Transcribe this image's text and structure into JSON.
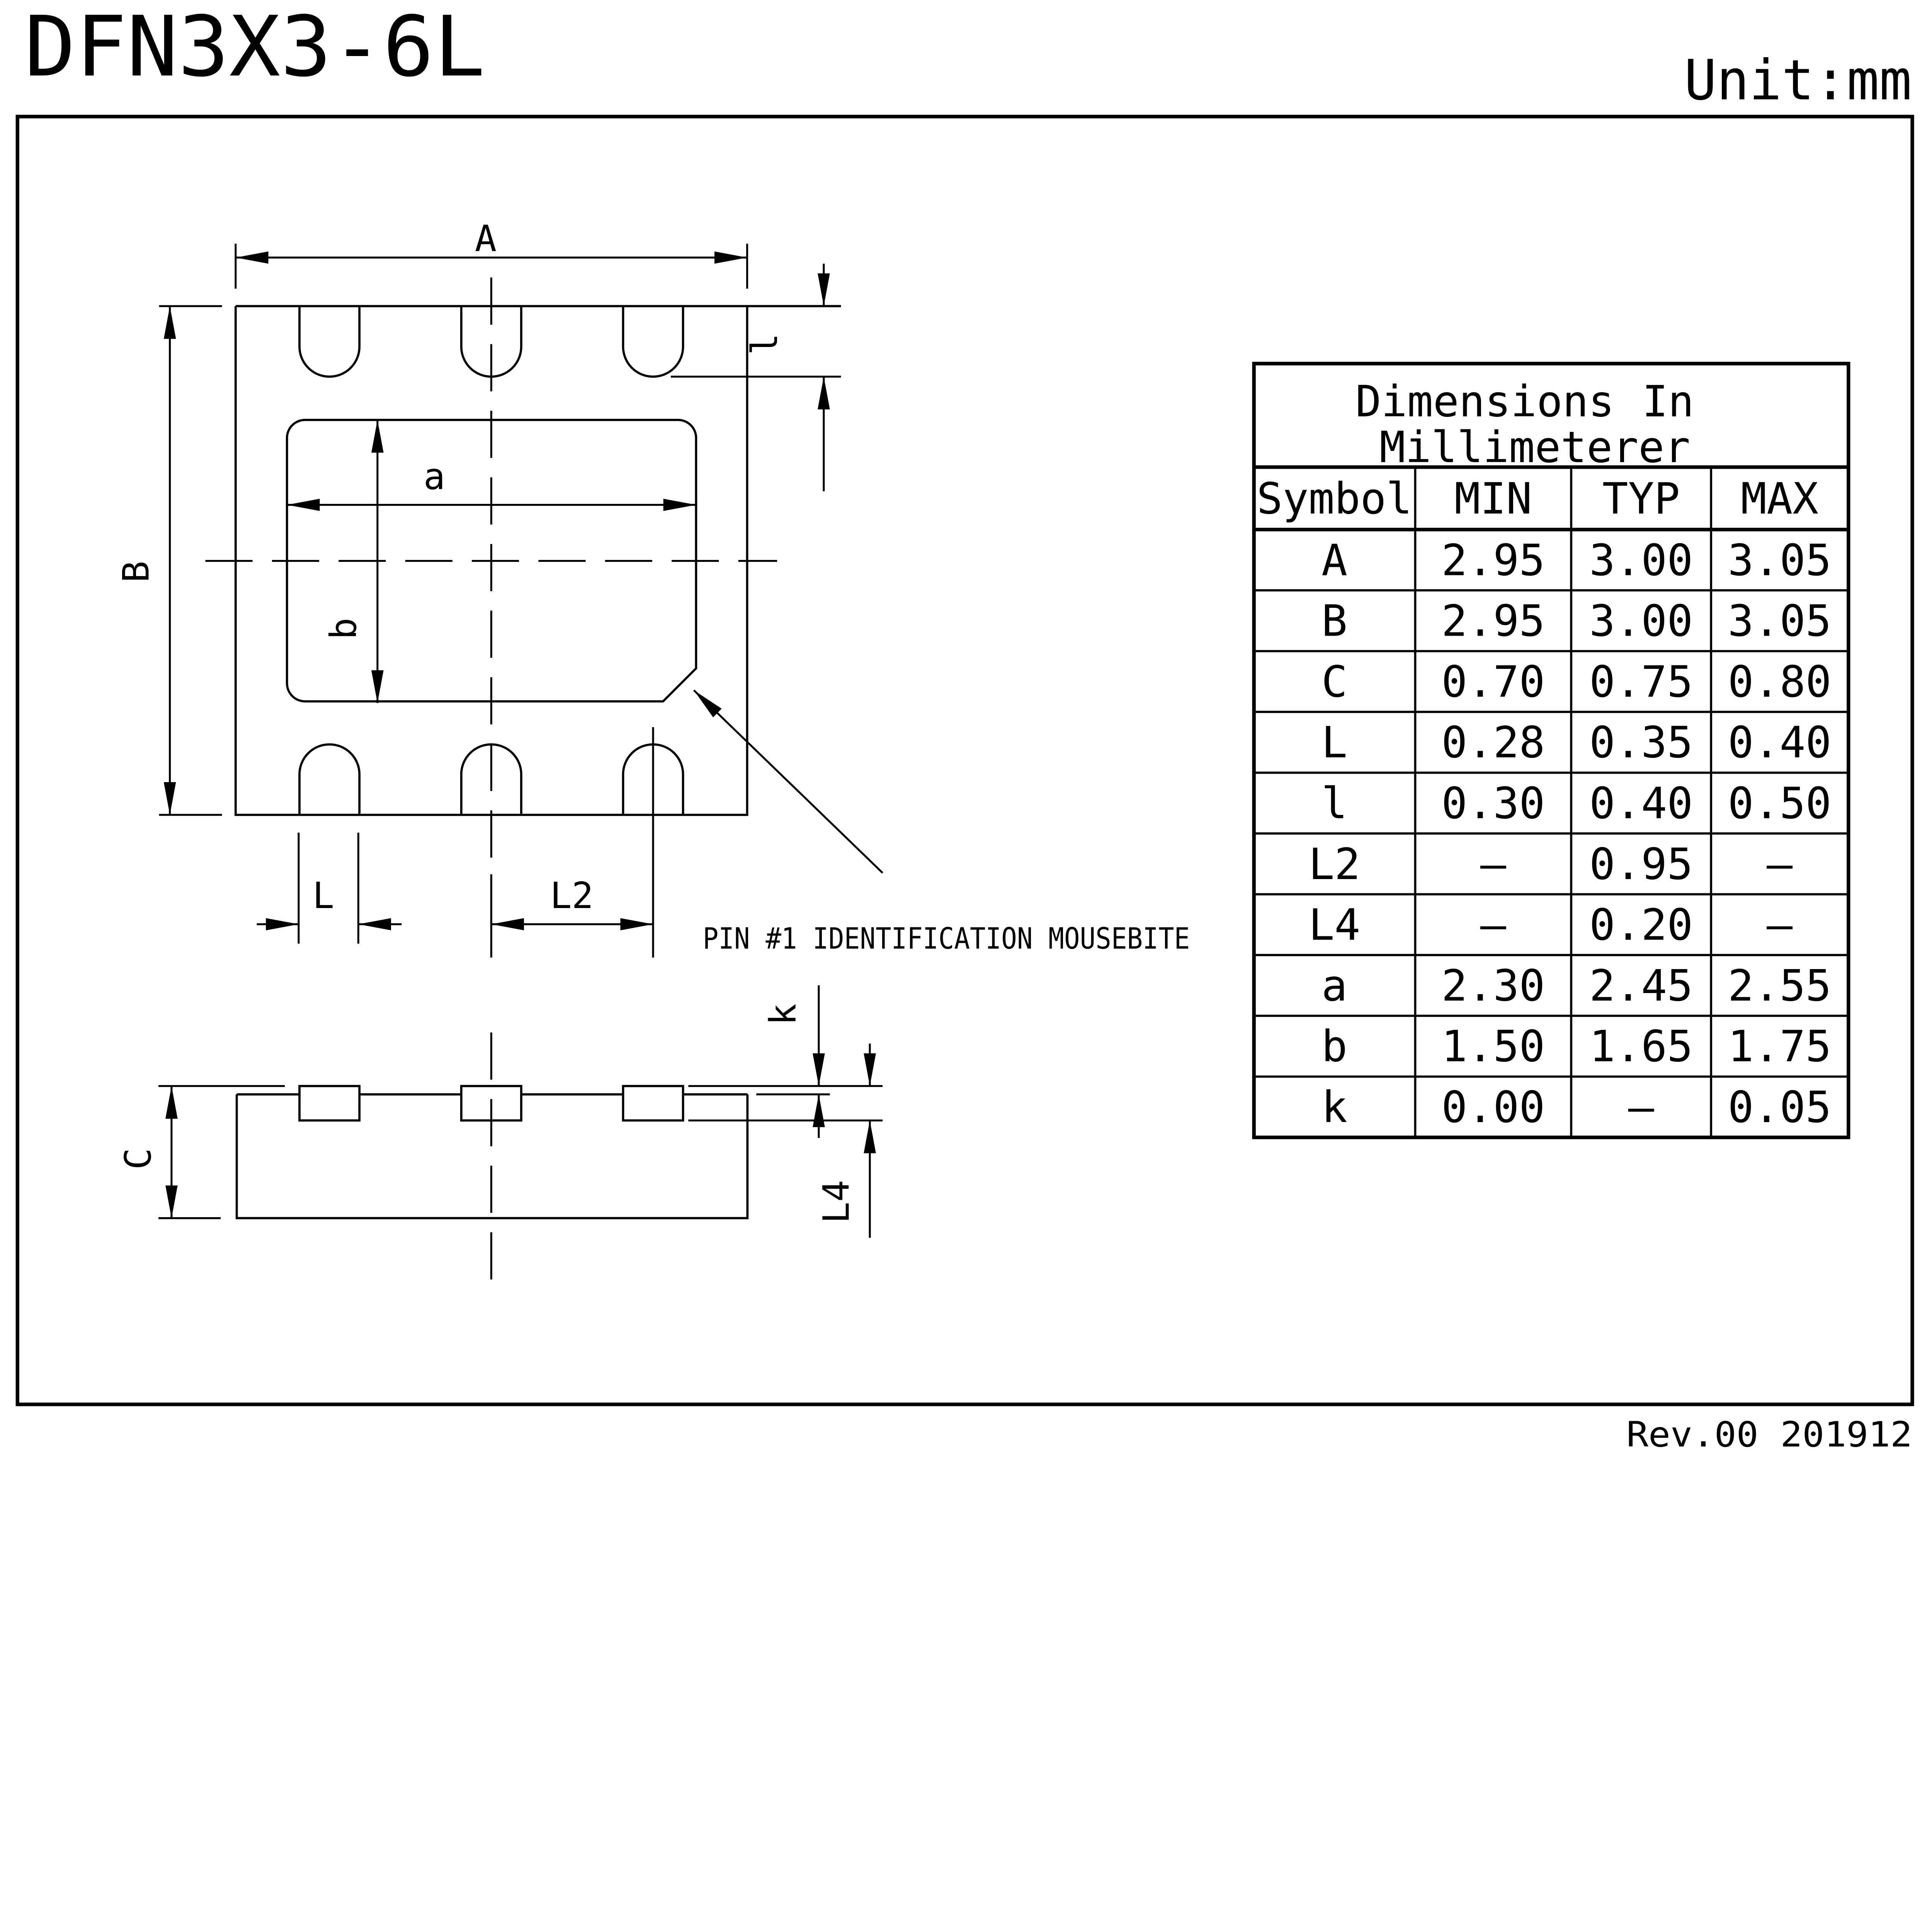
{
  "title": "DFN3X3-6L",
  "unit_label": "Unit:mm",
  "revision": "Rev.00  201912",
  "drawing": {
    "pin1_note": "PIN #1 IDENTIFICATION MOUSEBITE",
    "labels": {
      "A": "A",
      "B": "B",
      "a": "a",
      "b": "b",
      "small_l": "l",
      "L": "L",
      "L2": "L2",
      "C": "C",
      "k": "k",
      "L4": "L4"
    }
  },
  "table": {
    "title_word1": "Dimensions",
    "title_word2": "In",
    "title_line2": "Millimeterer",
    "headers": {
      "symbol": "Symbol",
      "min": "MIN",
      "typ": "TYP",
      "max": "MAX"
    },
    "rows": [
      {
        "symbol": "A",
        "min": "2.95",
        "typ": "3.00",
        "max": "3.05"
      },
      {
        "symbol": "B",
        "min": "2.95",
        "typ": "3.00",
        "max": "3.05"
      },
      {
        "symbol": "C",
        "min": "0.70",
        "typ": "0.75",
        "max": "0.80"
      },
      {
        "symbol": "L",
        "min": "0.28",
        "typ": "0.35",
        "max": "0.40"
      },
      {
        "symbol": "l",
        "min": "0.30",
        "typ": "0.40",
        "max": "0.50"
      },
      {
        "symbol": "L2",
        "min": "–",
        "typ": "0.95",
        "max": "–"
      },
      {
        "symbol": "L4",
        "min": "–",
        "typ": "0.20",
        "max": "–"
      },
      {
        "symbol": "a",
        "min": "2.30",
        "typ": "2.45",
        "max": "2.55"
      },
      {
        "symbol": "b",
        "min": "1.50",
        "typ": "1.65",
        "max": "1.75"
      },
      {
        "symbol": "k",
        "min": "0.00",
        "typ": "–",
        "max": "0.05"
      }
    ]
  }
}
